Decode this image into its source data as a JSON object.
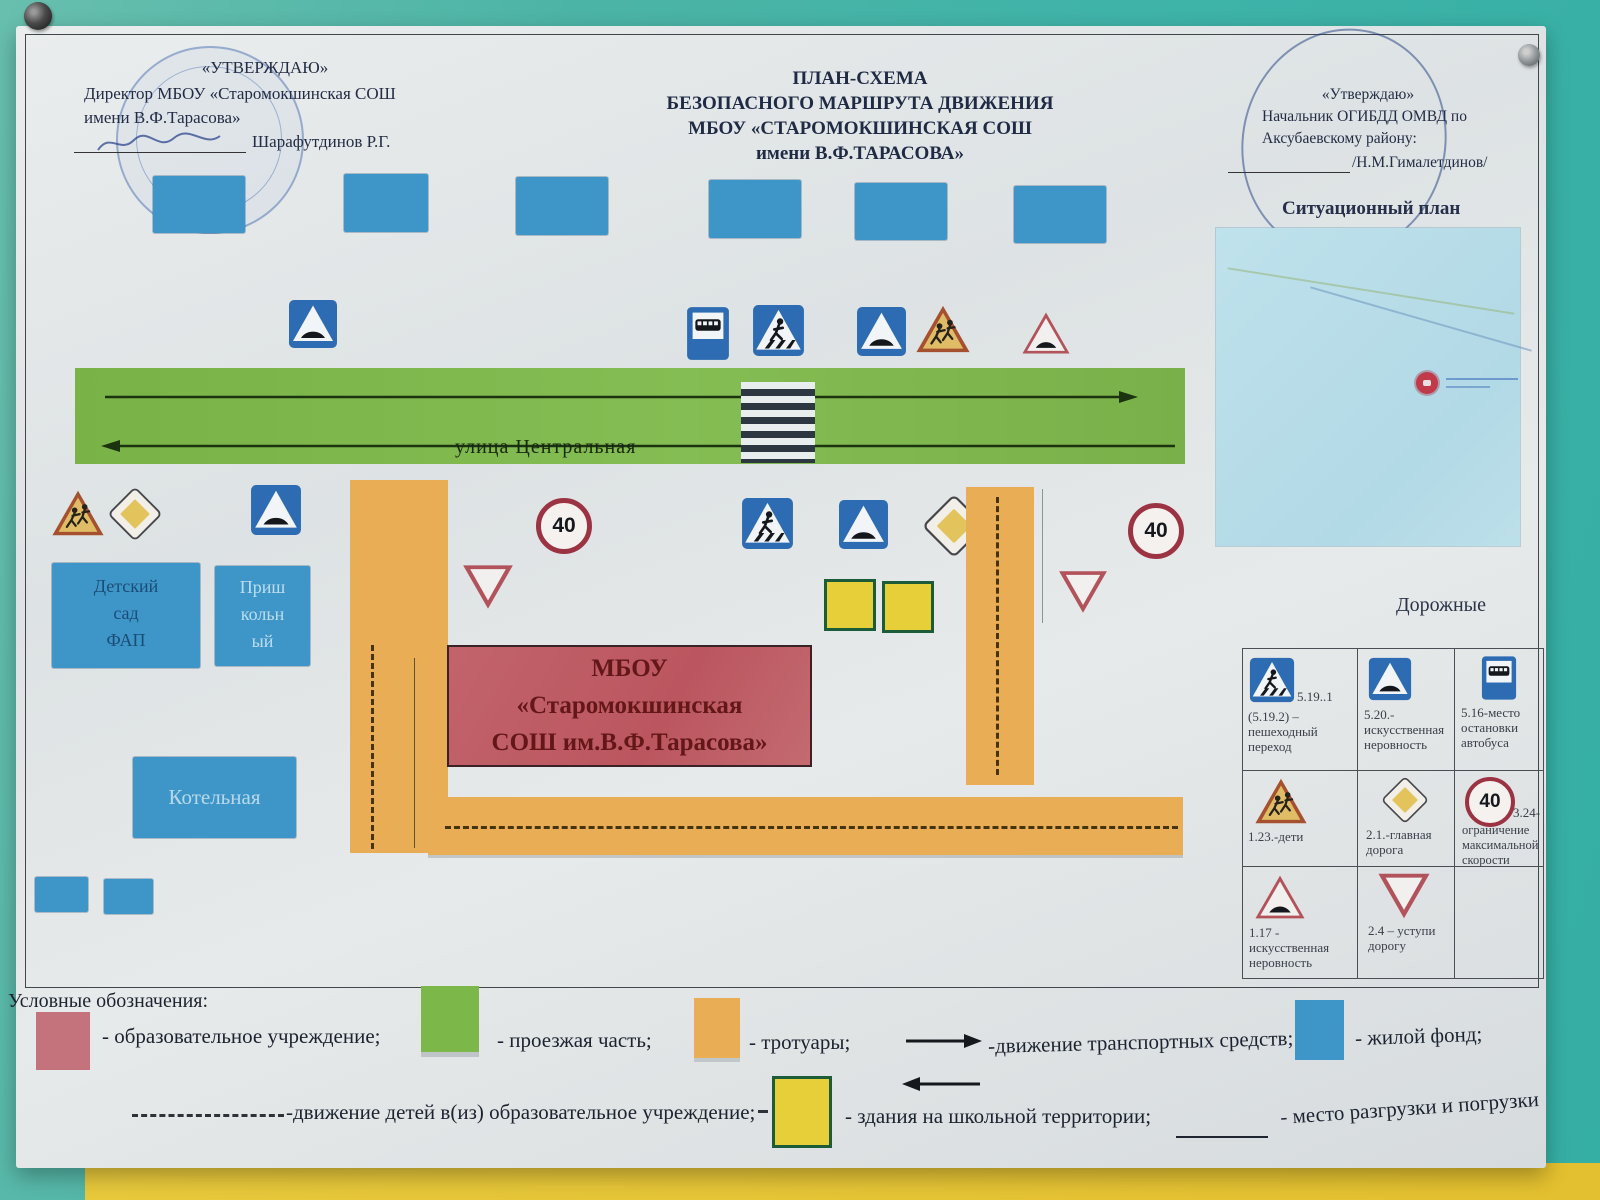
{
  "header": {
    "left": {
      "approve": "«УТВЕРЖДАЮ»",
      "line2": "Директор МБОУ «Старомокшинская СОШ",
      "line3": "имени В.Ф.Тарасова»",
      "signature": "Шарафутдинов Р.Г."
    },
    "center": {
      "line1": "ПЛАН-СХЕМА",
      "line2": "БЕЗОПАСНОГО МАРШРУТА  ДВИЖЕНИЯ",
      "line3": "МБОУ «СТАРОМОКШИНСКАЯ СОШ",
      "line4": "имени В.Ф.ТАРАСОВА»"
    },
    "right": {
      "approve": "«Утверждаю»",
      "line2": "Начальник ОГИБДД ОМВД по",
      "line3": "Аксубаевскому району:",
      "signature": "/Н.М.Гималетдинов/"
    }
  },
  "situational_plan": {
    "title": "Ситуационный план"
  },
  "map": {
    "street_label": "улица Центральная",
    "speed_limit": "40",
    "kindergarten": {
      "line1": "Детский",
      "line2": "сад",
      "line3": "ФАП"
    },
    "school_annex": {
      "line1": "Приш",
      "line2": "кольн",
      "line3": "ый"
    },
    "boiler_house": "Котельная",
    "school": {
      "line1": "МБОУ",
      "line2": "«Старомокшинская",
      "line3": "СОШ им.В.Ф.Тарасова»"
    }
  },
  "signs_table": {
    "title": "Дорожные",
    "c11_code": "5.19..1",
    "c11": "(5.19.2) – пешеходный переход",
    "c12": "5.20.- искусственная неровность",
    "c13": "5.16-место остановки автобуса",
    "c21": "1.23.-дети",
    "c22": "2.1.-главная дорога",
    "c23_code": "3.24-",
    "c23": "ограничение максимальной скорости",
    "c31": "1.17 - искусственная неровность",
    "c32": "2.4 – уступи дорогу"
  },
  "legend": {
    "heading": "Условные обозначения:",
    "edu": "- образовательное учреждение;",
    "road": "- проезжая часть;",
    "sidewalk": "- тротуары;",
    "traffic": "-движение транспортных средств;",
    "housing": "- жилой фонд;",
    "children": "-движение детей в(из) образовательное учреждение;",
    "school_buildings": "- здания на школьной территории;",
    "loading": "- место разгрузки и погрузки"
  },
  "colors": {
    "road_green": "#7cb74a",
    "sidewalk_orange": "#e9ad55",
    "housing_blue": "#3e96c8",
    "school_red": "#c05f66",
    "school_yellow": "#e6cf39",
    "wall_teal": "#3eb3a8",
    "wall_yellow": "#e5c435"
  },
  "icons": {
    "pushpin-icon": "round wall pin",
    "stamp-icon": "round blue ink stamp",
    "pen-circle-icon": "hand-drawn pen oval",
    "bus-stop-icon": "5.16 bus stop sign",
    "pedestrian-crossing-icon": "5.19 pedestrian crossing sign",
    "speed-bump-info-icon": "5.20 artificial hump sign",
    "children-warning-icon": "1.23 children warning sign",
    "speed-bump-warning-icon": "1.17 artificial hump warning sign",
    "priority-road-icon": "2.1 main road sign",
    "speed-limit-40-icon": "3.24 speed limit 40 sign",
    "yield-icon": "2.4 give way sign",
    "zebra-crossing-icon": "zebra crossing stripes",
    "location-pin-icon": "red map location marker",
    "arrow-right-icon": "vehicle flow arrow right",
    "arrow-left-icon": "vehicle flow arrow left"
  }
}
